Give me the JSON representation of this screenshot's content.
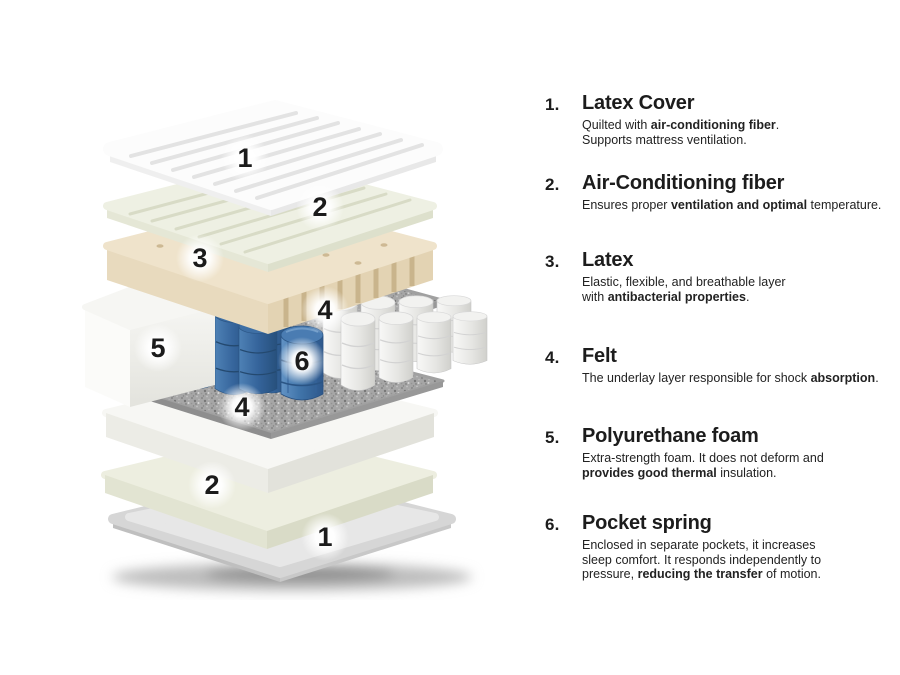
{
  "page": {
    "background": "#ffffff"
  },
  "colors": {
    "text": "#1c1c1c",
    "spring_blue": "#3a6ca5",
    "latex_tan": "#efe3cb",
    "felt_gray": "#a6a6a6",
    "fiber_green": "#eef0e3"
  },
  "diagram": {
    "layer_numbers": [
      "1",
      "2",
      "3",
      "4",
      "5",
      "6",
      "4",
      "2",
      "1"
    ]
  },
  "legend": {
    "items": [
      {
        "number": "1.",
        "title": "Latex Cover",
        "description": [
          {
            "t": "Quilted with "
          },
          {
            "t": "air-conditioning fiber",
            "b": true
          },
          {
            "t": ".\nSupports mattress ventilation."
          }
        ]
      },
      {
        "number": "2.",
        "title": "Air-Conditioning fiber",
        "description": [
          {
            "t": "Ensures proper "
          },
          {
            "t": "ventilation and optimal",
            "b": true
          },
          {
            "t": " temperature."
          }
        ]
      },
      {
        "number": "3.",
        "title": "Latex",
        "description": [
          {
            "t": "Elastic, flexible, and breathable layer\nwith "
          },
          {
            "t": "antibacterial properties",
            "b": true
          },
          {
            "t": "."
          }
        ]
      },
      {
        "number": "4.",
        "title": "Felt",
        "description": [
          {
            "t": "The underlay layer responsible for shock "
          },
          {
            "t": "absorption",
            "b": true
          },
          {
            "t": "."
          }
        ]
      },
      {
        "number": "5.",
        "title": "Polyurethane foam",
        "description": [
          {
            "t": "Extra-strength foam. It does not deform and\n"
          },
          {
            "t": "provides good thermal",
            "b": true
          },
          {
            "t": " insulation."
          }
        ]
      },
      {
        "number": "6.",
        "title": "Pocket spring",
        "description": [
          {
            "t": "Enclosed in separate pockets, it increases\nsleep comfort. It responds independently to\npressure, "
          },
          {
            "t": "reducing the transfer",
            "b": true
          },
          {
            "t": " of motion."
          }
        ]
      }
    ]
  }
}
